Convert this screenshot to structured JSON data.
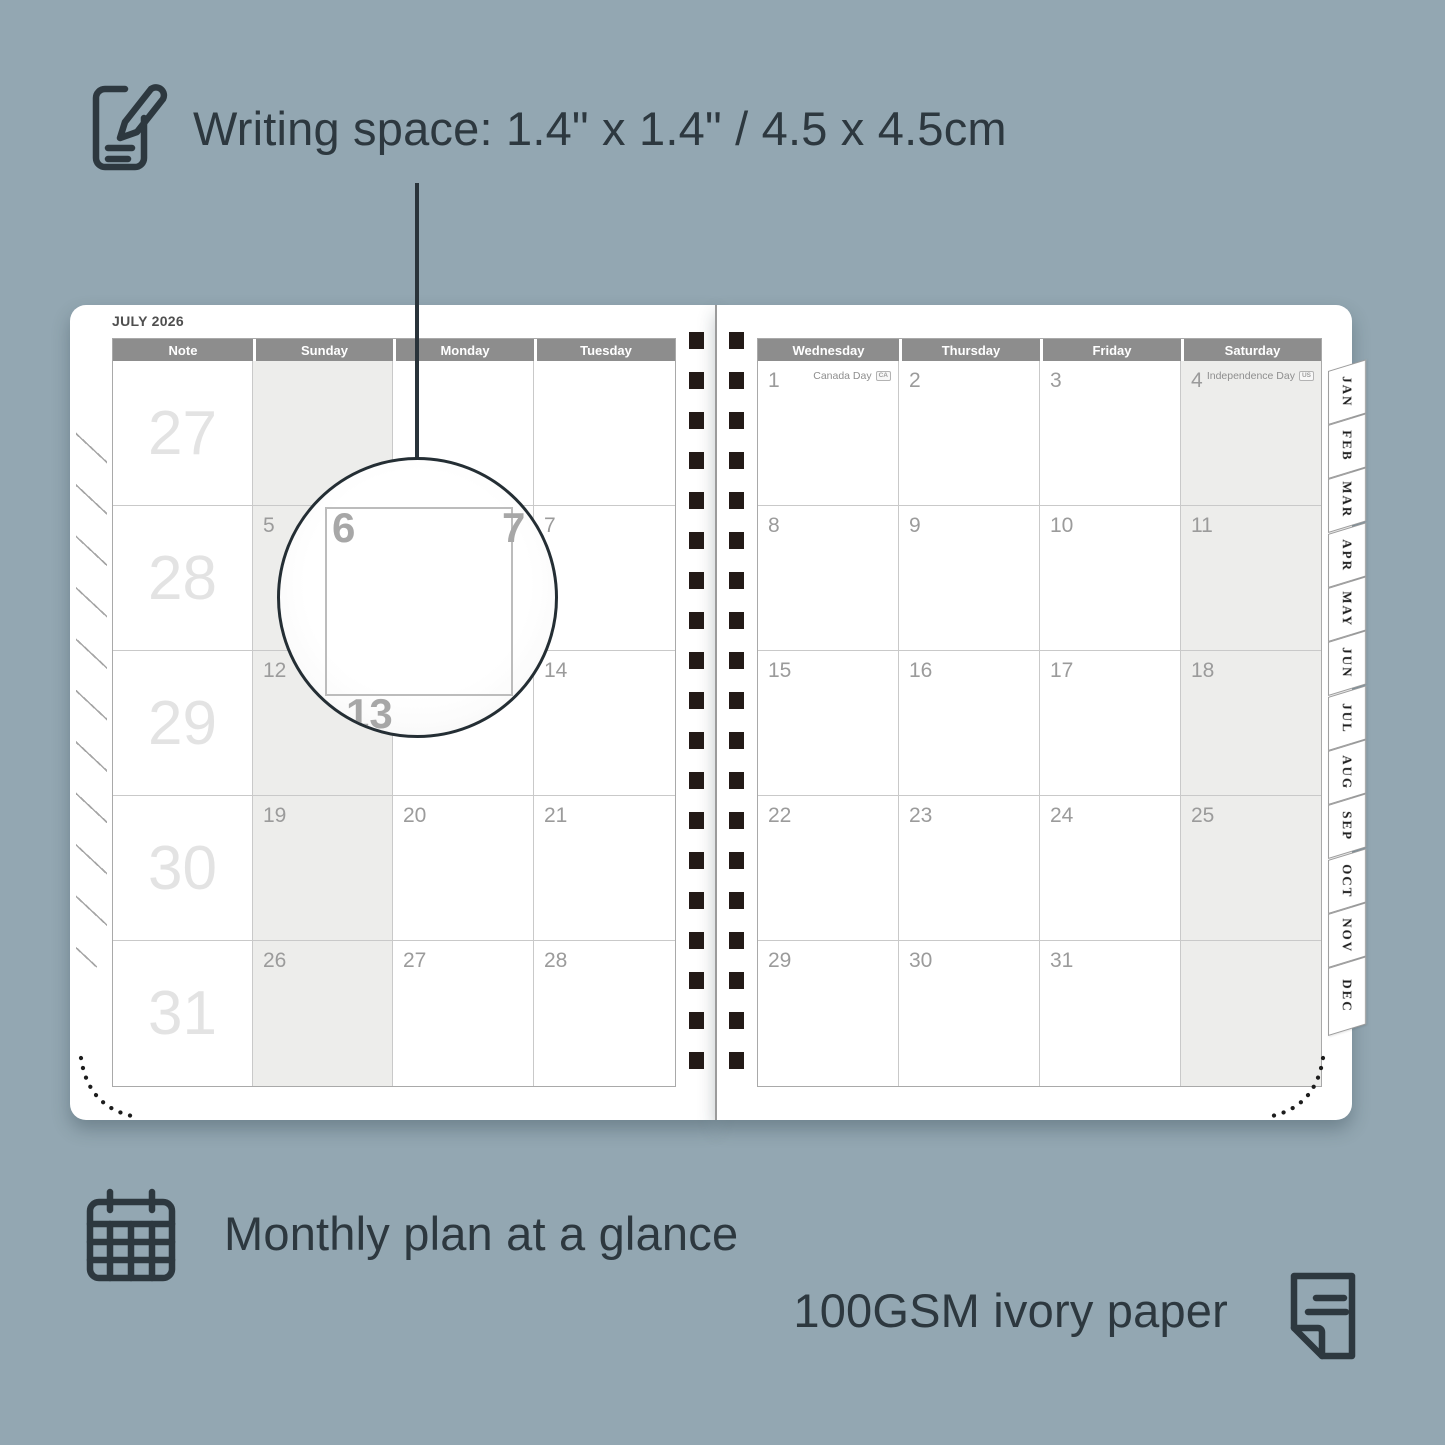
{
  "captions": {
    "writing_space": "Writing space: 1.4\" x 1.4\" / 4.5 x 4.5cm",
    "monthly_plan": "Monthly plan at a glance",
    "paper": "100GSM ivory paper"
  },
  "colors": {
    "background": "#93a7b2",
    "ink": "#2d383f",
    "header_gray": "#8d8d8d",
    "weekend_shade": "#ededeb",
    "date_number": "#9b9b9b",
    "week_number": "#e3e3e3",
    "spiral_square": "#231a17",
    "page": "#ffffff"
  },
  "planner": {
    "month_title": "JULY 2026",
    "left_page": {
      "headers": [
        "Note",
        "Sunday",
        "Monday",
        "Tuesday"
      ],
      "week_numbers": [
        "27",
        "28",
        "29",
        "30",
        "31"
      ],
      "rows": [
        [
          "",
          "",
          ""
        ],
        [
          "5",
          "6",
          "7"
        ],
        [
          "12",
          "13",
          "14"
        ],
        [
          "19",
          "20",
          "21"
        ],
        [
          "26",
          "27",
          "28"
        ]
      ]
    },
    "right_page": {
      "headers": [
        "Wednesday",
        "Thursday",
        "Friday",
        "Saturday"
      ],
      "rows": [
        [
          "1",
          "2",
          "3",
          "4"
        ],
        [
          "8",
          "9",
          "10",
          "11"
        ],
        [
          "15",
          "16",
          "17",
          "18"
        ],
        [
          "22",
          "23",
          "24",
          "25"
        ],
        [
          "29",
          "30",
          "31",
          ""
        ]
      ],
      "holidays": [
        {
          "date": "1",
          "label": "Canada Day",
          "badge": "CA"
        },
        {
          "date": "4",
          "label": "Independence Day",
          "badge": "US"
        }
      ]
    },
    "tabs": [
      "JAN",
      "FEB",
      "MAR",
      "APR",
      "MAY",
      "JUN",
      "JUL",
      "AUG",
      "SEP",
      "OCT",
      "NOV",
      "DEC"
    ],
    "magnifier": {
      "day": "6",
      "adjacent_day": "7",
      "next_week_day": "13"
    }
  }
}
